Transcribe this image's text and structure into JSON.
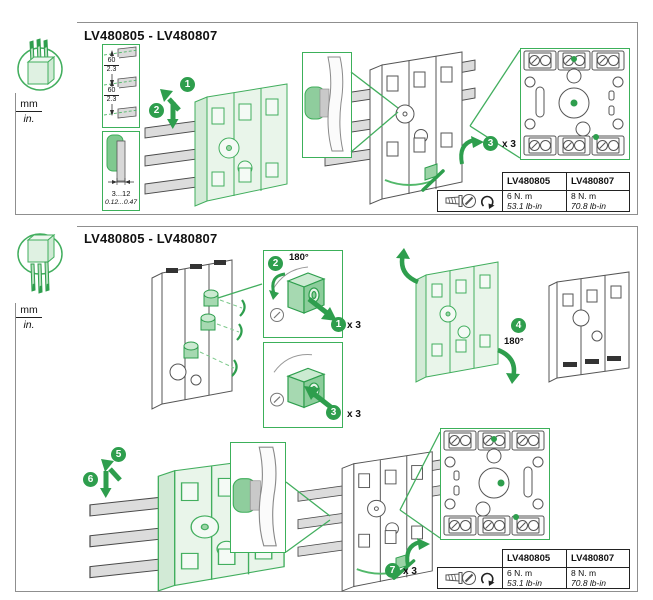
{
  "colors": {
    "accent_green": "#2E9E4D",
    "outline_green": "#3FAE5A",
    "fill_green_light": "#E9F5EA",
    "busbar_gray": "#DCDCDC",
    "panel_border_gray": "#8F8F8F",
    "text": "#111111"
  },
  "units": {
    "metric": "mm",
    "imperial": "in."
  },
  "torque_table": {
    "columns": [
      "LV480805",
      "LV480807"
    ],
    "values": [
      {
        "metric": "6 N. m",
        "imperial": "53.1 lb-in"
      },
      {
        "metric": "8 N. m",
        "imperial": "70.8 lb-in"
      }
    ]
  },
  "panel_mounting": {
    "title": "LV480805 - LV480807",
    "busbar_spacing": {
      "mm": "60",
      "in": "2.3"
    },
    "busbar_thickness": {
      "mm": "3...12",
      "in": "0.12...0.47"
    },
    "steps": [
      {
        "n": "1"
      },
      {
        "n": "2"
      },
      {
        "n": "3",
        "repeat": "x 3"
      }
    ]
  },
  "panel_reversal": {
    "title": "LV480805 - LV480807",
    "steps": [
      {
        "n": "1",
        "repeat": "x 3"
      },
      {
        "n": "2",
        "rotation": "180°"
      },
      {
        "n": "3",
        "repeat": "x 3"
      },
      {
        "n": "4",
        "rotation": "180°"
      },
      {
        "n": "5"
      },
      {
        "n": "6"
      },
      {
        "n": "7",
        "repeat": "x 3"
      }
    ]
  }
}
